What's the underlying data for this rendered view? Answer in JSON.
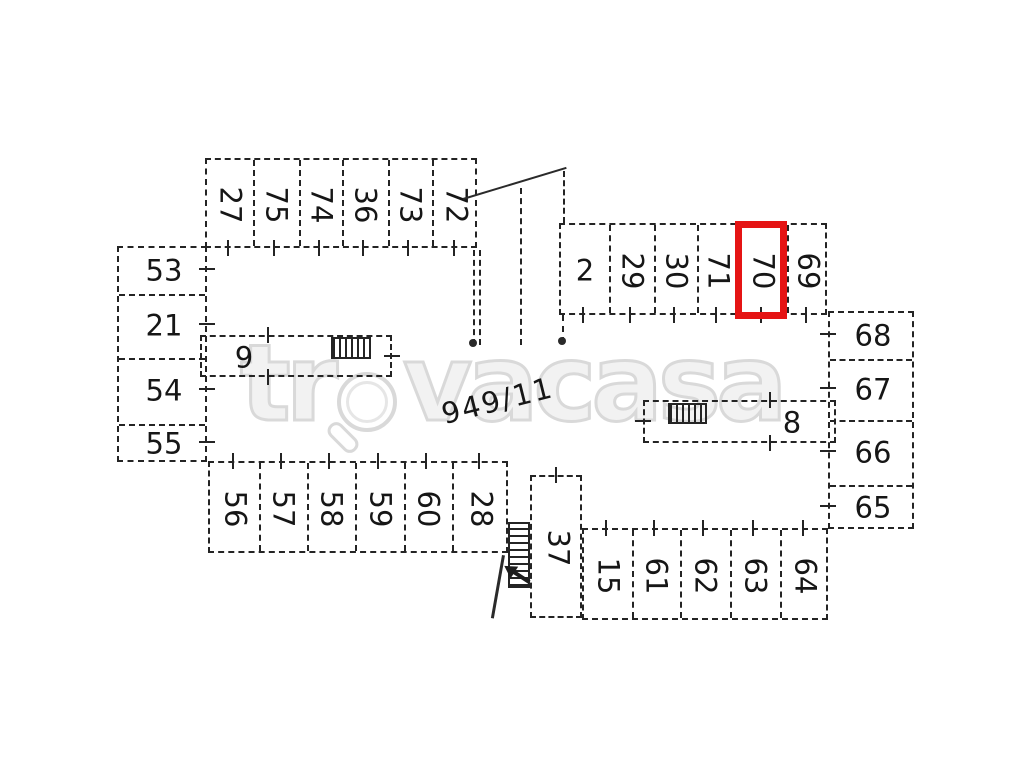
{
  "watermark": {
    "prefix": "tr",
    "suffix": "vacasa",
    "full": "trovacasa"
  },
  "parcel_label": "949/11",
  "highlight": {
    "unit": "70",
    "color": "#e51414"
  },
  "units": {
    "top_left_row": [
      "27",
      "75",
      "74",
      "36",
      "73",
      "72"
    ],
    "top_right_row": [
      "2",
      "29",
      "30",
      "71",
      "70",
      "69"
    ],
    "left_column": [
      "53",
      "21",
      "54",
      "55"
    ],
    "right_column": [
      "68",
      "67",
      "66",
      "65"
    ],
    "bottom_left_row": [
      "56",
      "57",
      "58",
      "59",
      "60",
      "28"
    ],
    "bottom_right_row": [
      "15",
      "61",
      "62",
      "63",
      "64"
    ],
    "strip_left": "9",
    "strip_right": "8",
    "stair_unit": "37"
  }
}
